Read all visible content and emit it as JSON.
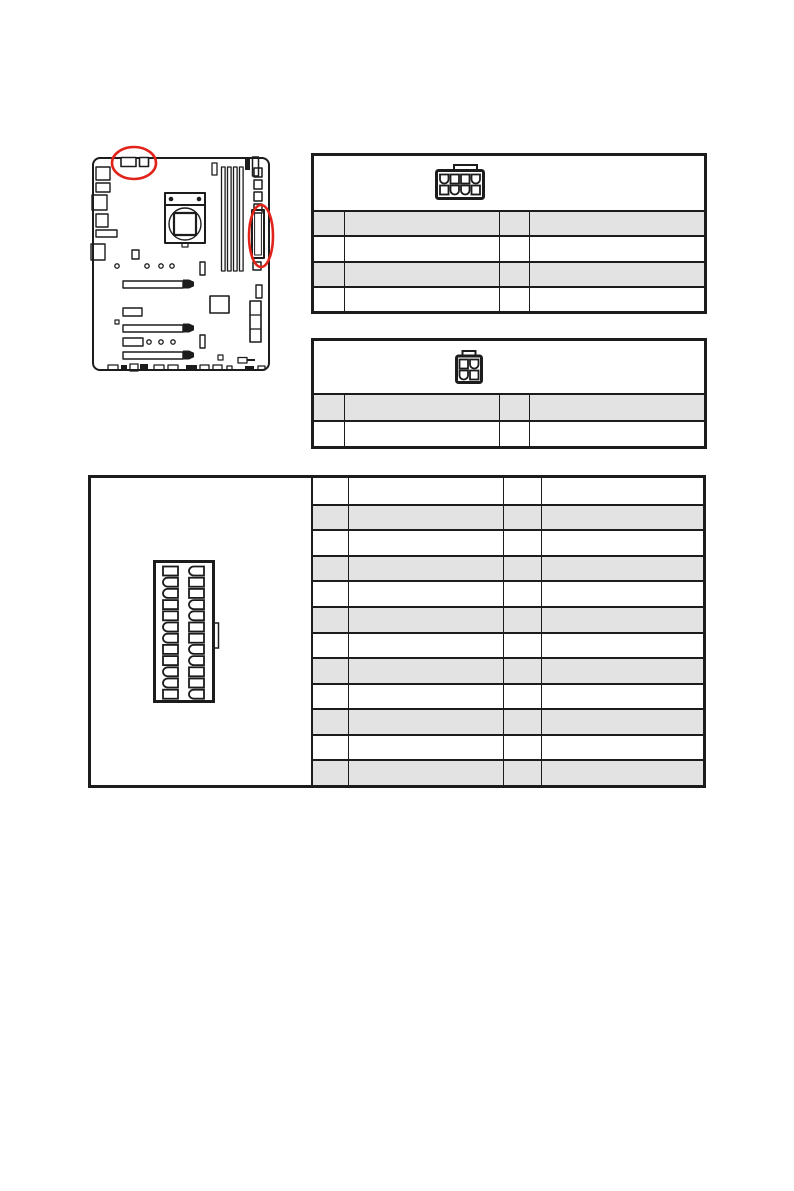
{
  "document": {
    "kind": "motherboard-manual-power-connector-page",
    "background": "#ffffff",
    "visible_text": ""
  },
  "colors": {
    "line_art": "#1c1c1c",
    "table_border": "#1c1c1c",
    "shaded_row": "#e3e3e3",
    "highlight_red": "#e2231a"
  },
  "motherboard_diagram": {
    "description": "line-art motherboard top view with two red highlight ellipses",
    "highlights": [
      {
        "id": "cpu-power-connector-highlight",
        "shape": "ellipse"
      },
      {
        "id": "atx-power-connector-highlight",
        "shape": "ellipse"
      }
    ]
  },
  "icons": {
    "pin8": {
      "name": "power-connector-8pin-icon",
      "pattern": [
        [
          "r",
          "s",
          "s",
          "r"
        ],
        [
          "s",
          "r",
          "r",
          "s"
        ]
      ]
    },
    "pin4": {
      "name": "power-connector-4pin-icon",
      "pattern": [
        [
          "s",
          "r"
        ],
        [
          "r",
          "s"
        ]
      ]
    },
    "pin24": {
      "name": "power-connector-24pin-icon",
      "pattern": [
        [
          "s",
          "r"
        ],
        [
          "r",
          "s"
        ],
        [
          "r",
          "s"
        ],
        [
          "s",
          "r"
        ],
        [
          "s",
          "r"
        ],
        [
          "r",
          "s"
        ],
        [
          "r",
          "s"
        ],
        [
          "s",
          "r"
        ],
        [
          "s",
          "r"
        ],
        [
          "r",
          "s"
        ],
        [
          "r",
          "s"
        ],
        [
          "s",
          "r"
        ]
      ]
    }
  },
  "tables": {
    "t8": {
      "title": "",
      "rows": [
        {
          "shaded": true,
          "cells": [
            "",
            "",
            "",
            ""
          ]
        },
        {
          "shaded": false,
          "cells": [
            "",
            "",
            "",
            ""
          ]
        },
        {
          "shaded": true,
          "cells": [
            "",
            "",
            "",
            ""
          ]
        },
        {
          "shaded": false,
          "cells": [
            "",
            "",
            "",
            ""
          ]
        }
      ]
    },
    "t4": {
      "title": "",
      "rows": [
        {
          "shaded": true,
          "cells": [
            "",
            "",
            "",
            ""
          ]
        },
        {
          "shaded": false,
          "cells": [
            "",
            "",
            "",
            ""
          ]
        }
      ]
    },
    "t24": {
      "title": "",
      "rows": [
        {
          "shaded": false,
          "cells": [
            "",
            "",
            "",
            ""
          ]
        },
        {
          "shaded": true,
          "cells": [
            "",
            "",
            "",
            ""
          ]
        },
        {
          "shaded": false,
          "cells": [
            "",
            "",
            "",
            ""
          ]
        },
        {
          "shaded": true,
          "cells": [
            "",
            "",
            "",
            ""
          ]
        },
        {
          "shaded": false,
          "cells": [
            "",
            "",
            "",
            ""
          ]
        },
        {
          "shaded": true,
          "cells": [
            "",
            "",
            "",
            ""
          ]
        },
        {
          "shaded": false,
          "cells": [
            "",
            "",
            "",
            ""
          ]
        },
        {
          "shaded": true,
          "cells": [
            "",
            "",
            "",
            ""
          ]
        },
        {
          "shaded": false,
          "cells": [
            "",
            "",
            "",
            ""
          ]
        },
        {
          "shaded": true,
          "cells": [
            "",
            "",
            "",
            ""
          ]
        },
        {
          "shaded": false,
          "cells": [
            "",
            "",
            "",
            ""
          ]
        },
        {
          "shaded": true,
          "cells": [
            "",
            "",
            "",
            ""
          ]
        }
      ]
    }
  }
}
